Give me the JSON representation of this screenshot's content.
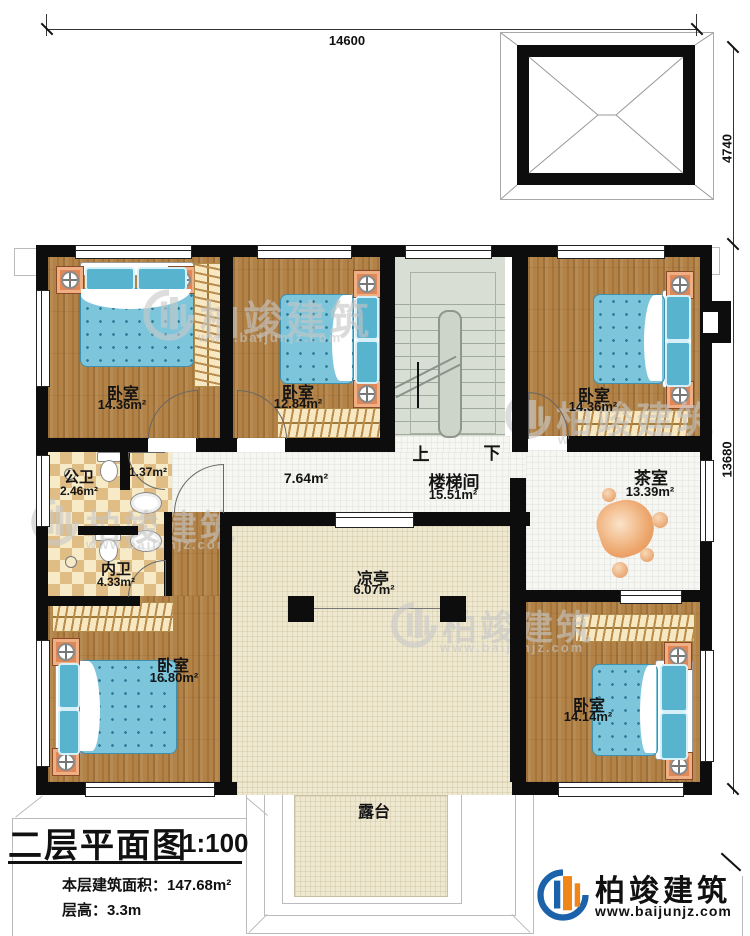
{
  "dimensions": {
    "top": "14600",
    "right_upper": "4740",
    "right_lower": "13680"
  },
  "rooms": {
    "bedroom_top_left": {
      "name": "卧室",
      "area": "14.36m²"
    },
    "bedroom_top_mid": {
      "name": "卧室",
      "area": "12.84m²"
    },
    "bedroom_top_right": {
      "name": "卧室",
      "area": "14.36m²"
    },
    "hall": {
      "area": "7.64m²"
    },
    "stairwell": {
      "name": "楼梯间",
      "area": "15.51m²",
      "up_label": "上",
      "down_label": "下"
    },
    "tea_room": {
      "name": "茶室",
      "area": "13.39m²"
    },
    "public_bathroom": {
      "name": "公卫",
      "area": "2.46m²"
    },
    "closet": {
      "area": "1.37m²"
    },
    "private_bathroom": {
      "name": "内卫",
      "area": "4.33m²"
    },
    "bedroom_bottom_left": {
      "name": "卧室",
      "area": "16.80m²"
    },
    "pavilion": {
      "name": "凉亭",
      "area": "6.07m²"
    },
    "bedroom_bottom_right": {
      "name": "卧室",
      "area": "14.14m²"
    },
    "terrace": {
      "name": "露台"
    }
  },
  "title_block": {
    "title": "二层平面图",
    "scale": "1:100",
    "floor_area": "本层建筑面积：147.68m²",
    "floor_height": "层高：3.3m"
  },
  "brand": {
    "name": "柏竣建筑",
    "url": "www.baijunjz.com"
  },
  "watermark": {
    "name": "柏竣建筑",
    "url": "www.baijunjz.com"
  }
}
